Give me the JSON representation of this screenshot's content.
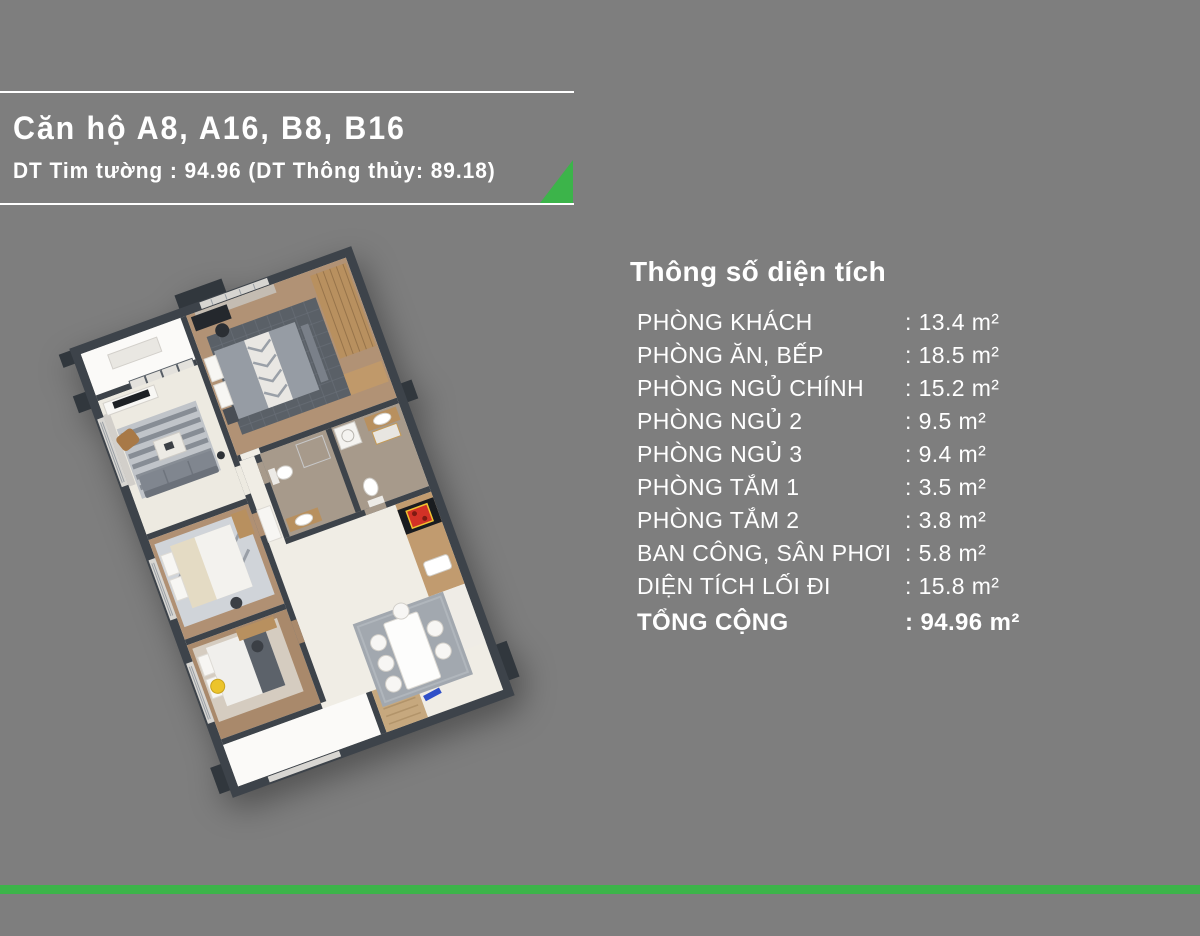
{
  "colors": {
    "background": "#7e7e7e",
    "accent_green": "#3cb44a",
    "text_white": "#ffffff",
    "plan_wall": "#3d434a"
  },
  "header": {
    "title": "Căn hộ A8, A16, B8, B16",
    "subtitle": "DT Tim tường : 94.96 (DT Thông thủy: 89.18)"
  },
  "area_table": {
    "title": "Thông số diện tích",
    "rows": [
      {
        "label": "PHÒNG KHÁCH",
        "value": ": 13.4 m²"
      },
      {
        "label": "PHÒNG ĂN, BẾP",
        "value": ": 18.5 m²"
      },
      {
        "label": "PHÒNG NGỦ CHÍNH",
        "value": ": 15.2 m²"
      },
      {
        "label": "PHÒNG NGỦ 2",
        "value": ": 9.5 m²"
      },
      {
        "label": "PHÒNG NGỦ 3",
        "value": ": 9.4 m²"
      },
      {
        "label": "PHÒNG TẮM 1",
        "value": ": 3.5 m²"
      },
      {
        "label": "PHÒNG TẮM 2",
        "value": ": 3.8 m²"
      },
      {
        "label": "BAN CÔNG, SÂN PHƠI",
        "value": ": 5.8 m²"
      },
      {
        "label": "DIỆN TÍCH LỐI ĐI",
        "value": ": 15.8 m²"
      }
    ],
    "total": {
      "label": "TỔNG CỘNG",
      "value": ": 94.96 m²"
    }
  },
  "floor_plan": {
    "illustration": "3d-isometric-apartment-floor-plan"
  }
}
